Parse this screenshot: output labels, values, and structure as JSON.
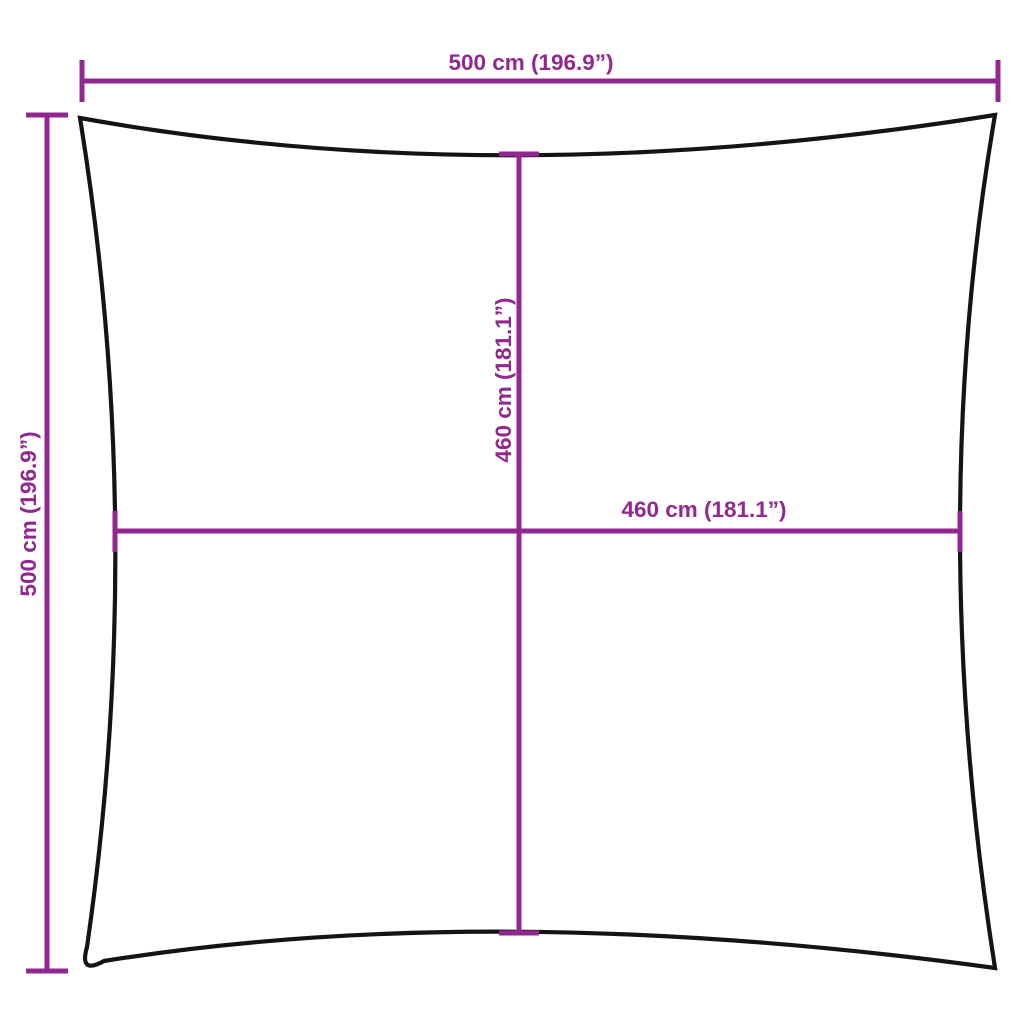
{
  "diagram": {
    "type": "product-dimension-diagram",
    "subject": "square shade sail with concave edges",
    "background_color": "#FFFFFF",
    "outline_color": "#141414",
    "dimension_color": "#92278F",
    "dimensions": {
      "top_width": {
        "label": "500 cm (196.9”)",
        "value_cm": 500,
        "value_in": 196.9
      },
      "left_height": {
        "label": "500 cm (196.9”)",
        "value_cm": 500,
        "value_in": 196.9
      },
      "inner_vertical": {
        "label": "460 cm (181.1”)",
        "value_cm": 460,
        "value_in": 181.1
      },
      "inner_horizontal": {
        "label": "460 cm (181.1”)",
        "value_cm": 460,
        "value_in": 181.1
      }
    }
  }
}
